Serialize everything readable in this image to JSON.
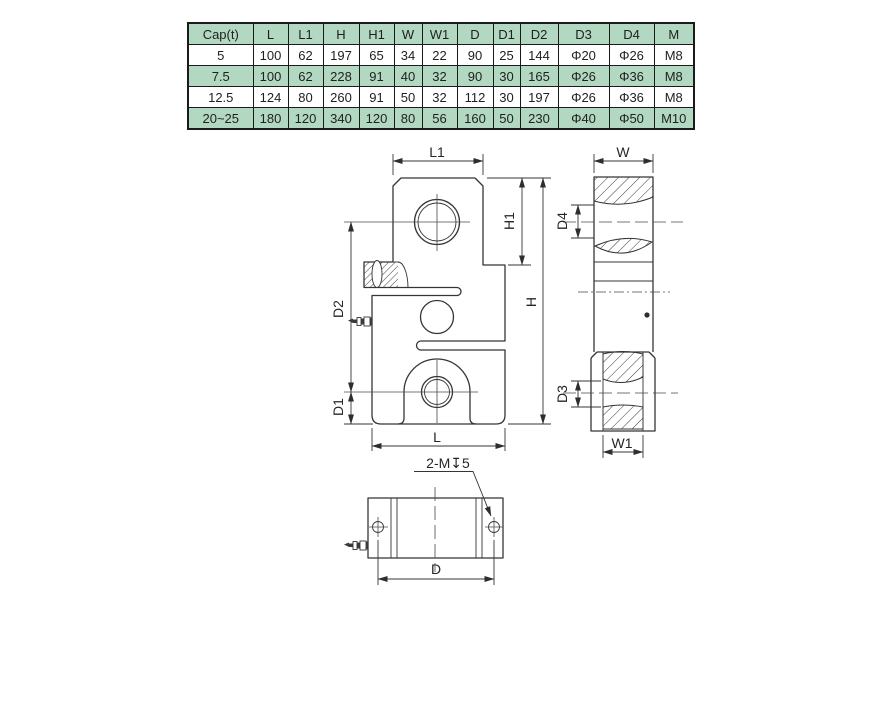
{
  "colors": {
    "table_row_green": "#b2d8c2",
    "table_row_white": "#ffffff",
    "line_color": "#353535",
    "background": "#ffffff"
  },
  "table": {
    "headers": [
      "Cap(t)",
      "L",
      "L1",
      "H",
      "H1",
      "W",
      "W1",
      "D",
      "D1",
      "D2",
      "D3",
      "D4",
      "M"
    ],
    "rows": [
      {
        "cells": [
          "5",
          "100",
          "62",
          "197",
          "65",
          "34",
          "22",
          "90",
          "25",
          "144",
          "Φ20",
          "Φ26",
          "M8"
        ]
      },
      {
        "cells": [
          "7.5",
          "100",
          "62",
          "228",
          "91",
          "40",
          "32",
          "90",
          "30",
          "165",
          "Φ26",
          "Φ36",
          "M8"
        ]
      },
      {
        "cells": [
          "12.5",
          "124",
          "80",
          "260",
          "91",
          "50",
          "32",
          "112",
          "30",
          "197",
          "Φ26",
          "Φ36",
          "M8"
        ]
      },
      {
        "cells": [
          "20~25",
          "180",
          "120",
          "340",
          "120",
          "80",
          "56",
          "160",
          "50",
          "230",
          "Φ40",
          "Φ50",
          "M10"
        ]
      }
    ]
  },
  "drawing": {
    "front": {
      "l1": "L1",
      "h1": "H1",
      "h": "H",
      "d2": "D2",
      "d1": "D1",
      "l": "L"
    },
    "side": {
      "w": "W",
      "d4": "D4",
      "d3": "D3",
      "w1": "W1"
    },
    "bottom": {
      "d": "D",
      "thread_note": "2-M↧5"
    }
  }
}
